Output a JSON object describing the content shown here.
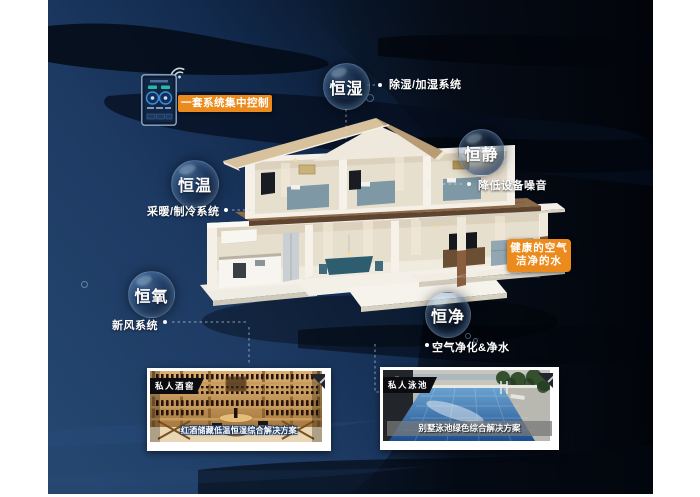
{
  "badges": {
    "humidity": "恒湿",
    "quiet": "恒静",
    "temperature": "恒温",
    "oxygen": "恒氧",
    "purity": "恒净"
  },
  "callouts": {
    "humidity": "除湿/加湿系统",
    "quiet": "降低设备噪音",
    "temperature": "采暖/制冷系统",
    "oxygen": "新风系统",
    "purity": "空气净化&净水"
  },
  "highlights": {
    "central_control": "一套系统集中控制",
    "healthy_air_line1": "健康的空气",
    "healthy_air_line2": "洁净的水"
  },
  "cards": {
    "wine_cellar": {
      "tag": "私人酒窖",
      "caption": "红酒储藏低温恒湿综合解决方案"
    },
    "pool": {
      "tag": "私人泳池",
      "caption": "别墅泳池绿色综合解决方案"
    }
  },
  "icons": {
    "wifi": "wifi-arcs"
  },
  "colors": {
    "accent_orange": "#ec8b1d",
    "background_navy": "#1d3a64",
    "background_black": "#04080f"
  }
}
